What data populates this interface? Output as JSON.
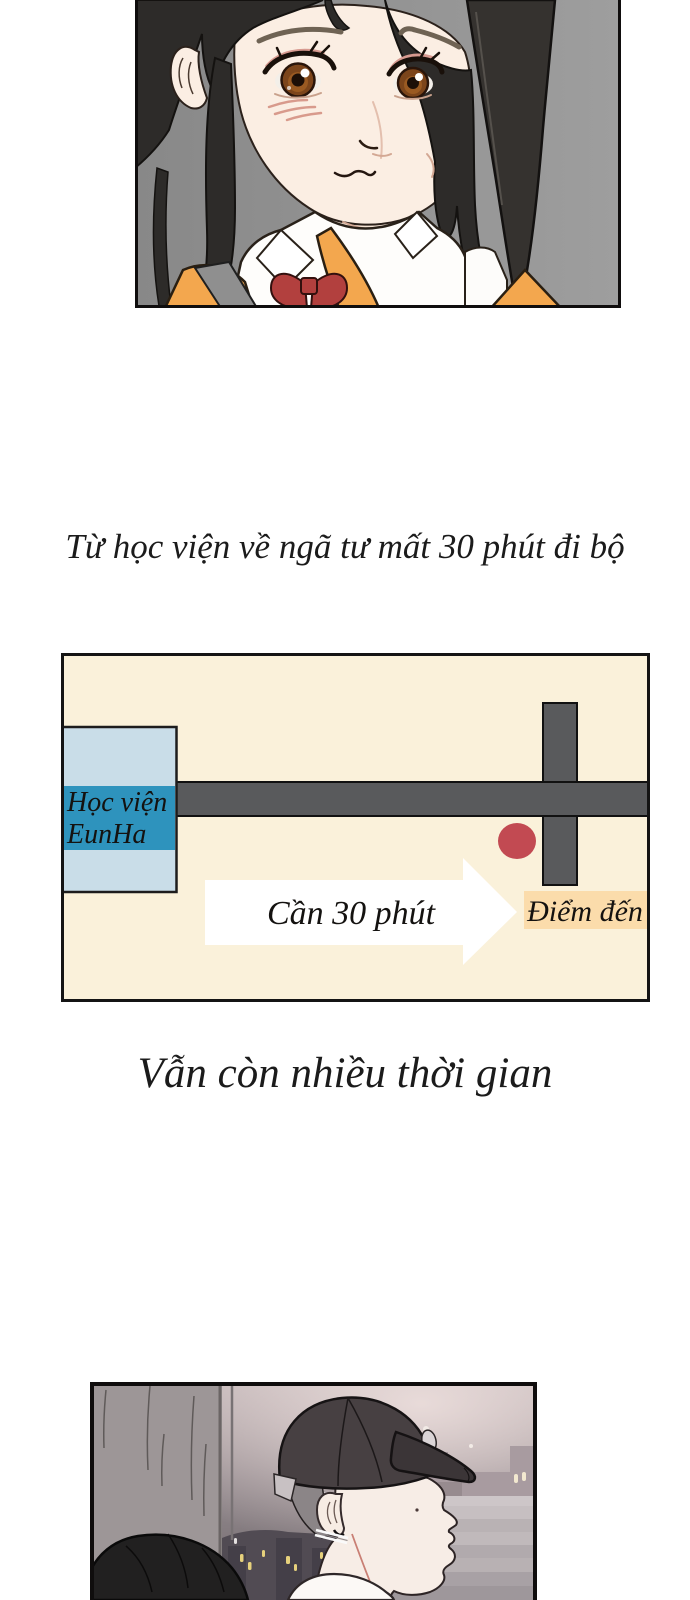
{
  "page": {
    "width": 690,
    "height": 1600,
    "background": "#ffffff"
  },
  "captions": {
    "narration_1": "Từ học viện về ngã tư mất 30 phút đi bộ",
    "narration_2": "Vẫn còn nhiều thời gian"
  },
  "panels": {
    "portrait": {
      "alt": "Schoolgirl with long black hair, white collar shirt, red bow and orange cardigan, looking worried",
      "bg_color": "#8f8f8f",
      "hair_color": "#2d2b29",
      "skin_color": "#fbeee3",
      "cardigan_color": "#f3a74e",
      "bow_color": "#b2403e"
    },
    "map": {
      "background_color": "#faf1da",
      "border_color": "#141414",
      "road_color": "#595a5c",
      "building": {
        "label": "Học viện EunHa",
        "label_lines": [
          "Học viện",
          "EunHa"
        ],
        "box_color": "#c9dde8",
        "band_color": "#2e93bd"
      },
      "marker_color": "#c24a52",
      "arrow": {
        "label": "Cần 30 phút",
        "fill": "#ffffff"
      },
      "destination": {
        "label": "Điểm đến",
        "box_color": "#fbdcab"
      }
    },
    "night": {
      "alt": "Young man wearing a dark baseball cap in profile at night, city lights and stairs behind, girl's hair in foreground",
      "cap_color": "#474042",
      "skin_color": "#f7ede6",
      "light_color": "#e6d17c"
    }
  }
}
